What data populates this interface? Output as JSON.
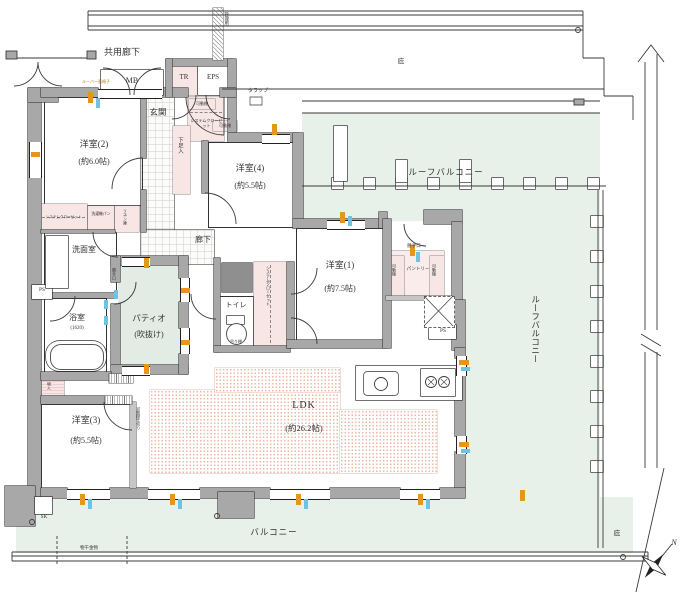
{
  "rooms": {
    "western2": {
      "name": "洋室(2)",
      "size": "(約6.0帖)"
    },
    "western4": {
      "name": "洋室(4)",
      "size": "(約5.5帖)"
    },
    "western1": {
      "name": "洋室(1)",
      "size": "(約7.5帖)"
    },
    "western3": {
      "name": "洋室(3)",
      "size": "(約5.5帖)"
    },
    "ldk": {
      "name": "LDK",
      "size": "(約26.2帖)"
    },
    "entrance_hall": {
      "name": "玄関"
    },
    "corridor": {
      "name": "廊下"
    },
    "washroom": {
      "name": "洗面室"
    },
    "bathroom": {
      "name": "浴室",
      "size": "(1620)"
    },
    "toilet": {
      "name": "トイレ"
    },
    "patio": {
      "name": "パティオ",
      "note": "(吹抜け)"
    },
    "pantry": {
      "name": "パントリー"
    }
  },
  "outdoor": {
    "common_corridor": "共用廊下",
    "roof_balcony": "ルーフバルコニー",
    "balcony": "バルコニー",
    "eaves": "庇",
    "laundry_fixture": "物干金物"
  },
  "features": {
    "mb": "MB",
    "tr": "TR",
    "eps": "EPS",
    "ps": "PS",
    "sk": "SK",
    "shoe_closet": "下足入",
    "system_closet": "システムクローゼット",
    "movable_shelf": "可動棚",
    "laundry_pan": "洗濯機パン",
    "linen_closet": "リネン庫",
    "hanging_shelf": "吊り棚",
    "storage": "物入",
    "movable_partition": "可動間仕切り",
    "service_door": "勝手口",
    "ladder": "タラップ",
    "louver_grille": "ルーバー面格子",
    "maintenance": "管理用"
  },
  "compass": {
    "north": "N"
  },
  "colors": {
    "wall": "#a8a8a8",
    "balcony_tint": "#e8f0ea",
    "closet_pink": "#f7e6e4",
    "ldk_dot_pink": "#efc0b0",
    "window_orange": "#e3971f",
    "screen_cyan": "#6ec3e4"
  }
}
